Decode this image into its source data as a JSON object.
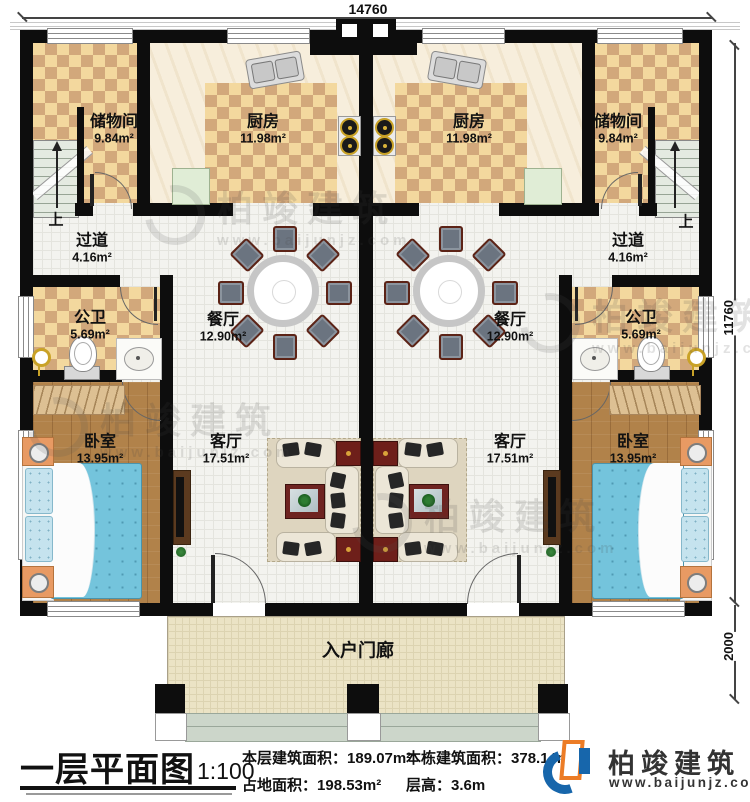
{
  "dimensions": {
    "top": "14760",
    "side": "11760",
    "porch": "2000"
  },
  "stairs": {
    "up": "上"
  },
  "rooms": {
    "storage": {
      "name": "储物间",
      "area": "9.84m²"
    },
    "kitchen": {
      "name": "厨房",
      "area": "11.98m²"
    },
    "hallway": {
      "name": "过道",
      "area": "4.16m²"
    },
    "bathroom": {
      "name": "公卫",
      "area": "5.69m²"
    },
    "dining": {
      "name": "餐厅",
      "area": "12.90m²"
    },
    "living": {
      "name": "客厅",
      "area": "17.51m²"
    },
    "bedroom": {
      "name": "卧室",
      "area": "13.95m²"
    },
    "porch": {
      "name": "入户门廊"
    }
  },
  "title_block": {
    "title": "一层平面图",
    "scale": "1:100",
    "stats": [
      {
        "label": "本层建筑面积：",
        "value": "189.07m²"
      },
      {
        "label": "占地面积：",
        "value": "198.53m²"
      },
      {
        "label": "本栋建筑面积：",
        "value": "378.14m²"
      },
      {
        "label": "层高：",
        "value": "3.6m"
      }
    ]
  },
  "brand": {
    "name": "柏竣建筑",
    "site": "www.baijunjz.com"
  },
  "watermark": {
    "text": "柏竣建筑",
    "site": "www.baijunjz.com"
  },
  "colors": {
    "wall": "#0d0d0d",
    "check_light": "#f3d89e",
    "check_dark": "#d2a87b",
    "wood": "#b1824a",
    "bed_blue": "#74c4dc",
    "brand_blue": "#1766ab",
    "brand_orange": "#ec7c26"
  }
}
